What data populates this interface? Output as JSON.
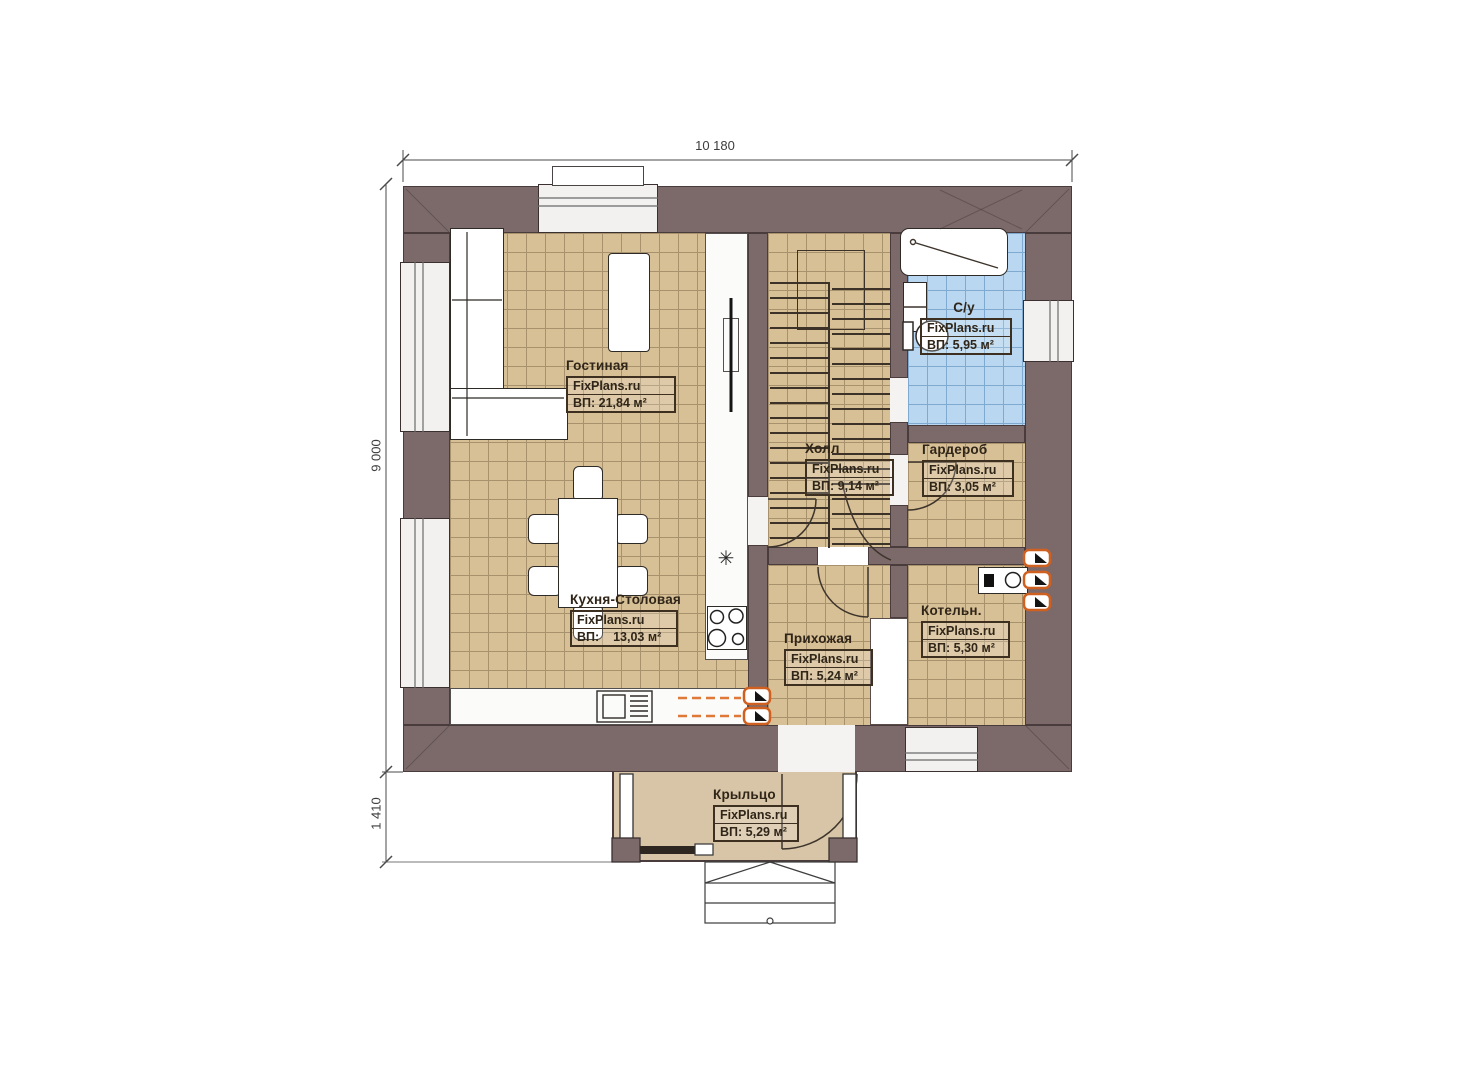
{
  "plan": {
    "watermark": "FixPlans.ru",
    "dimensions": {
      "top": "10 180",
      "left": "9 000",
      "porch": "1 410"
    },
    "icons": {
      "sink": "✳"
    },
    "rooms": [
      {
        "name": "Гостиная",
        "area": "ВП: 21,84 м²"
      },
      {
        "name": "Кухня-Столовая",
        "area": "ВП:    13,03 м²"
      },
      {
        "name": "Холл",
        "area": "ВП: 9,14 м²"
      },
      {
        "name": "С/у",
        "area": "ВП: 5,95 м²"
      },
      {
        "name": "Гардероб",
        "area": "ВП: 3,05 м²"
      },
      {
        "name": "Прихожая",
        "area": "ВП: 5,24 м²"
      },
      {
        "name": "Котельн.",
        "area": "ВП: 5,30 м²"
      },
      {
        "name": "Крыльцо",
        "area": "ВП: 5,29 м²"
      }
    ]
  }
}
